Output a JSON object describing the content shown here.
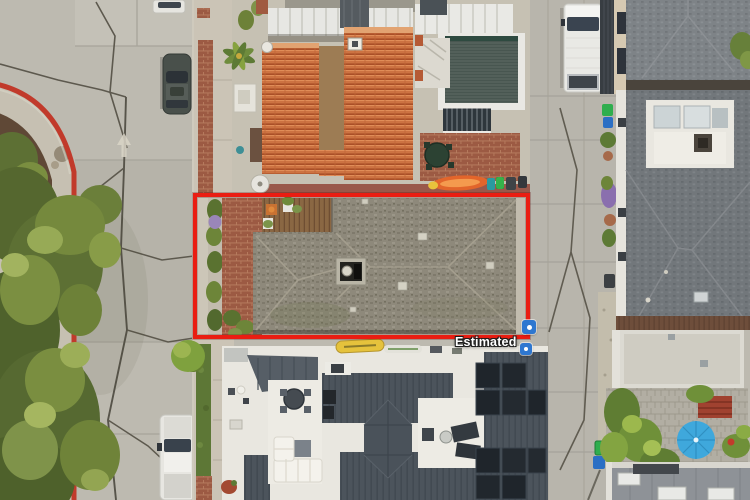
{
  "overlay": {
    "estimated_label": "Estimated",
    "boundary_style": "estimated-lot-line",
    "marker_icon": "property-pin-icon"
  },
  "theme": {
    "boundary_red": "#ea1d12",
    "marker_blue": "#2e77d0",
    "label_white": "#ffffff"
  }
}
